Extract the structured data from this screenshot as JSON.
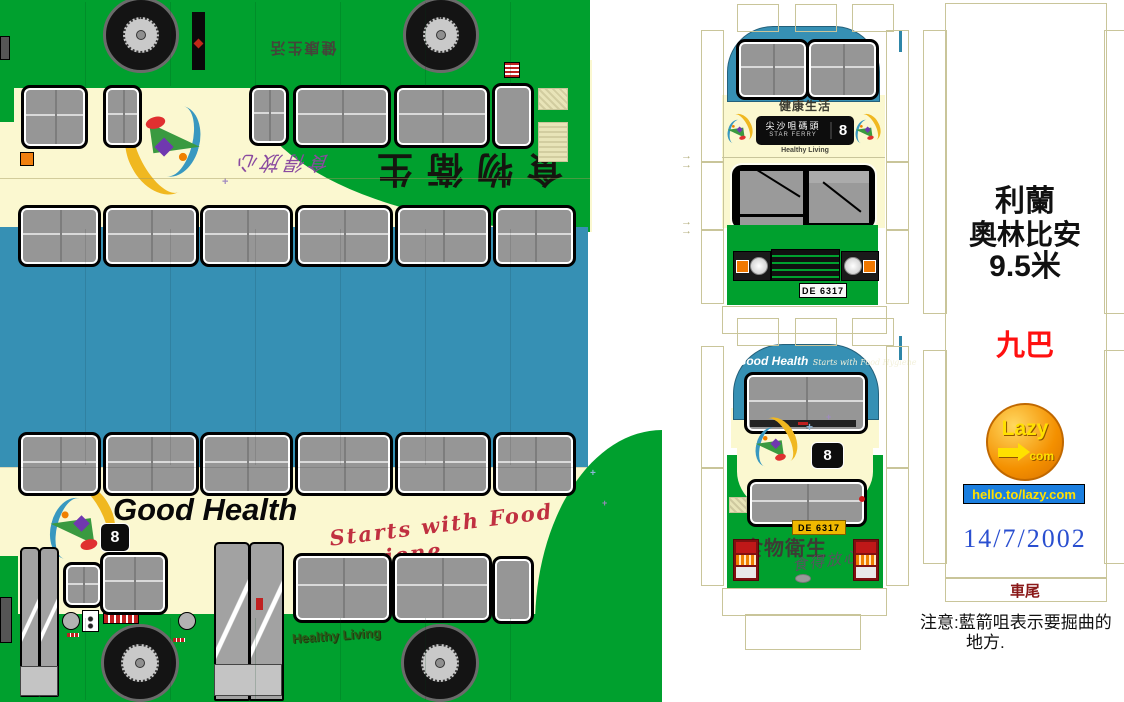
{
  "title": "KMB Leyland Olympian 9.5m paper bus model sheet",
  "colors": {
    "bus_green": "#00a02e",
    "roof_blue": "#3690b4",
    "body_cream": "#fbf8d0",
    "fold_line_tan": "#c9c59a",
    "operator_red": "#ff1010",
    "rear_label_maroon": "#8a1818",
    "date_blue": "#2a4fd0",
    "lazy_orange": "#f49000",
    "link_bar_blue": "#1b7fe0",
    "link_text_yellow": "#ffe000"
  },
  "side": {
    "brand_text": "Good Health",
    "brand_script": "Starts with Food Hygiene",
    "route_number": "8",
    "healthy_living": "Healthy Living",
    "roof_strip_text": "健康生活",
    "top_rotated_text": "食物衛生",
    "top_rotated_script": "食得放心"
  },
  "front": {
    "header_text": "健康生活",
    "destination_line1": "尖沙咀碼頭",
    "destination_line2": "STAR FERRY",
    "route_number": "8",
    "sub_text": "Healthy Living",
    "license_plate": "DE 6317"
  },
  "rear": {
    "brand_text": "Good Health",
    "brand_script": "Starts with Food Hygiene",
    "route_number": "8",
    "license_plate": "DE 6317",
    "chinese_text": "食物衛生",
    "chinese_script": "食得放心"
  },
  "info_panel": {
    "model_line1": "利蘭",
    "model_line2": "奧林比安",
    "model_line3": "9.5米",
    "operator": "九巴",
    "logo_text": "Lazy",
    "logo_sub": "com",
    "link": "hello.to/lazy.com",
    "date": "14/7/2002",
    "rear_label": "車尾",
    "note_line1": "注意:藍箭咀表示要掘曲的",
    "note_line2": "地方."
  }
}
